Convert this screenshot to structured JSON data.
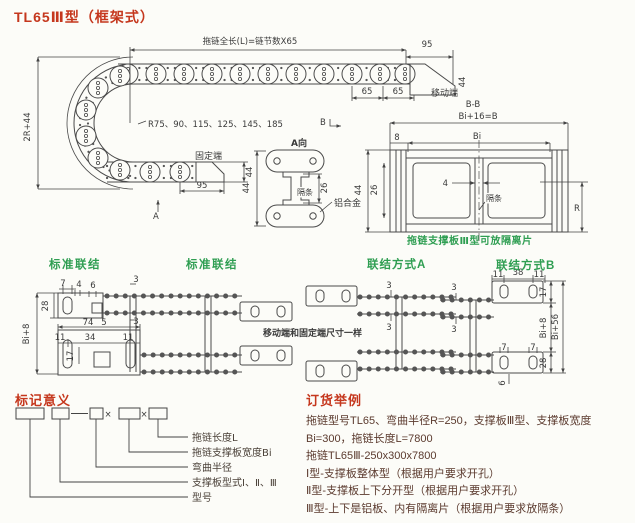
{
  "page": {
    "title": "TL65Ⅲ型（框架式）"
  },
  "colors": {
    "red": "#c5371d",
    "green": "#2f9e52",
    "ink": "#444444",
    "body": "#5b3a2e"
  },
  "top_view": {
    "length_formula": "拖链全长(L)=链节数X65",
    "dim_95_moving": "95",
    "dim_44_moving": "44",
    "dim_65_left": "65",
    "dim_65_right": "65",
    "moving_end_label": "移动端",
    "dim_2r_44": "2R+44",
    "radius_options": "R75、90、115、125、145、185",
    "fixed_end_label": "固定端",
    "dim_44_fixed": "44",
    "dim_95_fixed": "95",
    "section_arrow_a": "A",
    "section_arrow_b": "B"
  },
  "a_view": {
    "title": "A向",
    "dim_44": "44",
    "dim_26": "26",
    "spacer_label": "隔条",
    "material_label": "铝合金"
  },
  "bb_section": {
    "title": "B-B",
    "dim_overall": "Bi+16=B",
    "dim_bi": "Bi",
    "dim_8": "8",
    "dim_44": "44",
    "dim_26": "26",
    "dim_4": "4",
    "spacer_label": "隔条",
    "dim_r": "R",
    "note": "拖链支撑板Ⅲ型可放隔离片"
  },
  "connections": {
    "standard_left_title": "标准联结",
    "standard_right_title": "标准联结",
    "method_a_title": "联结方式A",
    "method_b_title": "联结方式B",
    "note_same_size": "移动端和固定端尺寸一样",
    "std": {
      "d7": "7",
      "d4": "4",
      "d6": "6",
      "d28": "28",
      "d5": "5",
      "d3_top": "3",
      "d3_bottom": "3",
      "d74": "74",
      "d11_left": "11",
      "d34": "34",
      "d11_right": "11",
      "d17": "17",
      "dbi8": "Bi+8"
    },
    "a": {
      "d3_top": "3",
      "d3_bottom": "3"
    },
    "b": {
      "d11_left": "11",
      "d38": "38",
      "d11_right": "11",
      "d17": "17",
      "d3_top": "3",
      "d3_bottom": "3",
      "dbi8": "Bi+8",
      "dbi56": "Bi+56",
      "d7_left": "7",
      "d7_right": "7",
      "d28": "28",
      "d6": "6"
    }
  },
  "marking": {
    "title": "标记意义",
    "times": "×",
    "labels": [
      "拖链长度L",
      "拖链支撑板宽度Bi",
      "弯曲半径",
      "支撑板型式Ⅰ、Ⅱ、Ⅲ",
      "型号"
    ]
  },
  "ordering": {
    "title": "订货举例",
    "lines": [
      "拖链型号TL65、弯曲半径R=250，支撑板Ⅲ型、支撑板宽度",
      "Bi=300，拖链长度L=7800",
      "拖链TL65Ⅲ-250x300x7800",
      "Ⅰ型-支撑板整体型（根据用户要求开孔）",
      "Ⅱ型-支撑板上下分开型（根据用户要求开孔）",
      "Ⅲ型-上下是铝板、内有隔离片（根据用户要求放隔条）"
    ]
  }
}
